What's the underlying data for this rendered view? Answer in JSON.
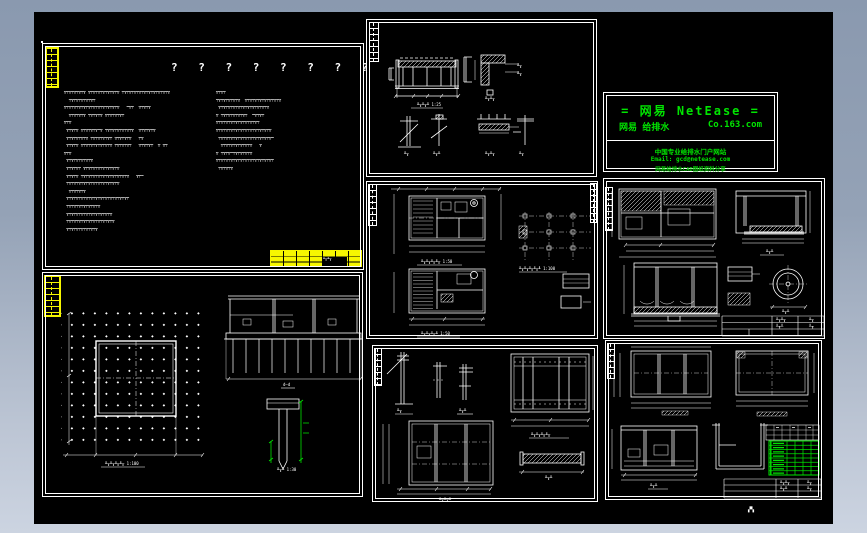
{
  "app": {
    "frame_top_color": "#8a99af",
    "frame_bottom_color": "#ccd4e1",
    "canvas_color": "#000000",
    "line_color": "#ffffff",
    "highlight_yellow": "#f6f600",
    "accent_green": "#00e400"
  },
  "notes_panel": {
    "title": "? ? ? ? ? ? ? ?",
    "left_lines": [
      "╦╤╦╤╦╤╦╤╦ ╦╤╦╤╦╤╦╤╦╤╦╤╦ ╤╦╤╦╤╦╤╦╤╦╤╦╤╦╤╦╤╦╤╦",
      "  ╤╦╤╦╤╦╤╦╤╦╤",
      "╦╤╦╤╦╤╦╤╦╤╦╤╦╤╦╤╦╤╦╤╦╤╦   ═╦╤  ╦╤╦╤╦",
      "  ╦╤╦╤╦╤╦ ╤╦╤╦╤╦ ╦╤╦╤╦╤╦╤",
      "╦╤╦",
      " ╦╤╦╤╦ ╦╤╦╤╦╤╦═╦ ╤╦╤╦╤╦╤╦╤╦╤╦  ╦╤╦╤╦╤╦",
      " ╦╤╦╤╦╤╦╤╦ ╤╦╤╦╤╦╤╦╤ ╦╤╦╤╦╤╦   ╤╦",
      " ╦╤╦╤╦ ╦╤╦╤╦╤╦╤╦╤╦╤╦ ╤╦╤╦╤╦╤   ╦╤╦╤╦╤  ╦ ╦╤",
      "╦╤╦",
      " ╦╤╦╤╦╤╦╤╦╤╦",
      " ╦╤╦╤╦╤ ╦╤╦╤╦╤╦╤╦╤╦╤╦╤╦",
      " ╦╤╦╤╦ ╤╦╤╦╤╦╤╦╤╦╤╦╤╦╤╦╤╦╤╦   ╦╤═",
      " ╤╦╤╦╤╦╤╦╤╦╤╦╤╦╤╦╤╦╤╦╤╦",
      "  ╦╤╦╤╦╤╦",
      " ╦╤╦╤╦╤╦╤╦╤╦╤╦╤╦╤╦╤╦╤╦╤╦╤╦╤",
      " ╤╦╤╦╤╦╤╦╤╦╤╦╤╦",
      " ╦╤╦╤╦╤╦╤╦╤╦╤╦╤╦╤╦╤╦",
      " ╤╦╤╦╤╦╤╦╤╦╤╦╤╦╤╦╤╦╤╦",
      " ╦╤╦╤╦╤╦╤╦╤╦╤╦"
    ],
    "right_lines": [
      "╦╤╦╤",
      "╤╦╤╦╤╦╤╦╤╦  ╦╤╦╤╦╤╦╤╦╤╦╤╦╤╦",
      " ╦╤╦╤╦╤╦╤╦╤╦╤╦╤╦╤╦╤╦╤╦",
      "╦ ╤╦╤╦╤╦╤╦╤╦╤  ═╦╤╦╤",
      "╦╤╦╤╦╤╦╤╦╤╦╤╦╤╦╤╦╤",
      "╦╤╦╤╦╤╦╤╦╤╦╤╦╤╦╤╦╤╦╤╦╤╦",
      " ╤╦╤╦╤╦╤╦╤╦╤╦╤╦╤╦╤╦╤╦╤╦═",
      "  ╦╤╦╤╦╤╦╤╦╤╦╤╦   ╦",
      "╦ ╤╦╤╦═╤╦╤╦╤╦╤╦",
      "╦╤╦╤╦╤╦╤╦╤╦╤╦╤╦╤╦╤╦╤╦╤╦╤",
      " ╤╦╤╦╤╦"
    ]
  },
  "logo_box": {
    "title": "=  网易 NetEase  =",
    "sub_left": "网易 给排水",
    "sub_right": "Co.163.com",
    "line1": "中国专业给排水门户网站",
    "line2": "Email: gcd@netease.com",
    "line3": "网易给排水CAD图纸资料分享"
  },
  "titles": {
    "p2_beam": "╨╥╨╥╨ 1:25",
    "p2_corner": "╨╥╨╥",
    "p2_b1": "╨╥",
    "p2_b2": "╨╥╨",
    "p2_plate": "╨╥╨╥",
    "p2_angle": "╨╥",
    "p3_plan_a": "╨╥╨╥╨╥╨╥ 1:50",
    "p3_plan_b": "╨╥╨╥╨╥╨ 1:50",
    "p3_grid": "╨╥╨╥╨╥╨╥╨ 1:100",
    "p4_section_r": "╨╥╨",
    "p4_circle": "╨╥╨",
    "p5_plan": "╨╥╨╥╨╥╨╥ 1:100",
    "p5_section": "d–d",
    "p5_pile": "╨╥╨ 1:30",
    "p6_s1": "╨╥",
    "p6_s2": "╨╥╨",
    "p6_plan_r": "╨╥╨╥╨╥╨╥",
    "p6_beam": "╨╥╨",
    "p6_plan_b": "╨╥╨╥╨",
    "p7_sec": "╨╥╨",
    "tb_a": "╨╥╨╥",
    "tb_b": "╨╥",
    "tb_c": "╨╥╨",
    "tb_d": "╨╥",
    "lead": "╨╥"
  },
  "rebar_schedule": {
    "rows": 8,
    "cols": 4,
    "left_col_bars": true
  },
  "page_label": "▞▚"
}
